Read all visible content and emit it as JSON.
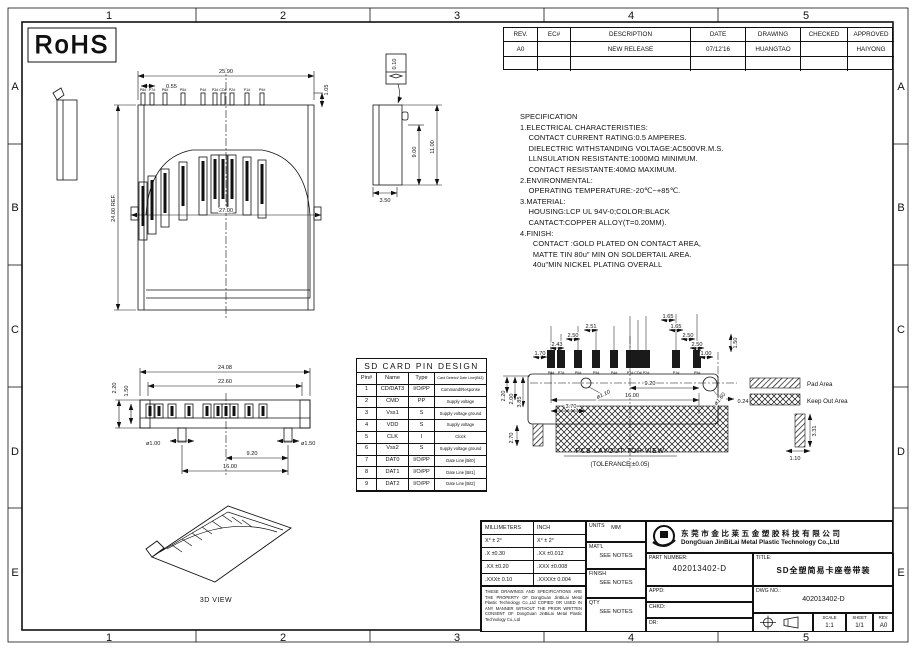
{
  "sheet": {
    "rohs": "RoHS",
    "zone_cols": [
      "1",
      "2",
      "3",
      "4",
      "5"
    ],
    "zone_rows": [
      "A",
      "B",
      "C",
      "D",
      "E"
    ]
  },
  "revision_table": {
    "headers": [
      "REV.",
      "EC#",
      "DESCRIPTION",
      "DATE",
      "DRAWING",
      "CHECKED",
      "APPROVED"
    ],
    "row": {
      "rev": "A0",
      "ec": "",
      "description": "NEW RELEASE",
      "date": "07/12'16",
      "drawing": "HUANGTAO",
      "checked": "",
      "approved": "HAIYONG"
    }
  },
  "specification": [
    "SPECIFICATION",
    "1.ELECTRICAL CHARACTERISTIES:",
    "    CONTACT CURRENT RATING:0.5 AMPERES.",
    "    DIELECTRIC WITHSTANDING VOLTAGE:AC500VR.M.S.",
    "    LLNSULATION RESISTANTE:1000MΩ MINIMUM.",
    "    CONTACT RESISTANTE:40MΩ MAXIMUM.",
    "2.ENVIRONMENTAL:",
    "    OPERATING TEMPERATURE:-20℃~+85℃.",
    "3.MATERIAL:",
    "    HOUSING:LCP UL 94V-0;COLOR:BLACK",
    "    CANTACT:COPPER ALLOY(T=0.20MM).",
    "4.FINISH:",
    "      CONTACT :GOLD PLATED ON CONTACT AREA,",
    "      MATTE TIN 80u\" MIN ON SOLDERTAIL AREA.",
    "      40u\"MIN NICKEL PLATING OVERALL"
  ],
  "pin_table": {
    "title": "SD CARD PIN DESIGN",
    "headers": [
      "Pin#",
      "Name",
      "Type",
      "Card Detetct/ Date Line(Bit3)"
    ],
    "rows": [
      [
        "1",
        "CD/DAT3",
        "I/O/PP",
        "Command/Response"
      ],
      [
        "2",
        "CMD",
        "PP",
        "Supply voltage"
      ],
      [
        "3",
        "Vss1",
        "S",
        "Supply voltage ground"
      ],
      [
        "4",
        "VDD",
        "S",
        "Supply voltage"
      ],
      [
        "5",
        "CLK",
        "I",
        "Clock"
      ],
      [
        "6",
        "Vss2",
        "S",
        "Supply voltage ground"
      ],
      [
        "7",
        "DAT0",
        "I/O/PP",
        "Date Line [Bit0]"
      ],
      [
        "8",
        "DAT1",
        "I/O/PP",
        "Date Line [Bit1]"
      ],
      [
        "9",
        "DAT2",
        "I/O/PP",
        "Date Line [Bit2]"
      ]
    ]
  },
  "pins": [
    "P8#",
    "P7#",
    "P6#",
    "P5#",
    "P4#",
    "P3#",
    "CD#",
    "P2#",
    "P1#",
    "P9#"
  ],
  "front_view": {
    "dim_width": "25.90",
    "dim_pitch": "0.55",
    "dim_lead": "1.05",
    "dim_flange": "27.00",
    "dim_depth": "24.00 REF."
  },
  "side_view": {
    "dim_inner": "9.00",
    "dim_outer": "11.00",
    "dim_width": "3.50",
    "flatness": "0.10"
  },
  "bottom_view": {
    "dim_overall": "24.08",
    "dim_body": "22.60",
    "dim_h1": "2.20",
    "dim_h2": "1.50",
    "dim_peg_left": "ø1.00",
    "dim_peg_right": "ø1.50",
    "dim_span1": "9.20",
    "dim_span2": "16.00"
  },
  "pcb_view": {
    "title": "PCB LAYOUT TOP VIEW",
    "tolerance": "(TOLERANCE:±0.05)",
    "d170": "1.70",
    "d243": "2.43",
    "d250a": "2.50",
    "d251": "2.51",
    "d165a": "1.65",
    "d165b": "1.65",
    "d250b": "2.50",
    "d250c": "2.50",
    "d100": "1.00",
    "d150": "1.50",
    "d110": "ø1.10",
    "d920": "9.20",
    "d1600": "16.00",
    "d370": "3.70",
    "d160": "ø1.60",
    "d024": "0.24",
    "d220": "2.20",
    "d200": "2.00",
    "d385": "3.85",
    "d270": "2.70",
    "d331": "3.31",
    "d110b": "1.10"
  },
  "legend": {
    "pad": "Pad Area",
    "keepout": "Keep Out Area"
  },
  "view3d_label": "3D VIEW",
  "title_block": {
    "tolerances": {
      "headers": [
        "MILLIMETERS",
        "INCH"
      ],
      "rows": [
        [
          "X°  ± 2°",
          "X°  ± 2°"
        ],
        [
          ".X  ±0.30",
          ".XX  ±0.012"
        ],
        [
          ".XX  ±0.20",
          ".XXX ±0.008"
        ],
        [
          ".XXX± 0.10",
          ".XXXX± 0.004"
        ]
      ]
    },
    "units_label": "UNITS",
    "units": "MM",
    "matl_label": "MAT'L",
    "matl": "SEE NOTES",
    "finish_label": "FINISH",
    "finish": "SEE NOTES",
    "qty_label": "QTY",
    "qty": "SEE NOTES",
    "legal": "THESE DRAWINGS AND SPECIFICATIONS ARE THE PROPERTY OF DongGuan JinBiLai Metal Plastic Technology Co.,Ltd COPIED OR USED IN ANY MANNER WITHOUT THE PRIOR WRITTEN CONSENT OF DongGuan JinBiLai Metal Plastic Technology Co.,Ltd",
    "company_cn": "东莞市金比莱五金塑胶科技有限公司",
    "company_en": "DongGuan JinBiLai Metal Plastic Technology Co.,Ltd",
    "part_number_label": "PART NUMBER:",
    "part_number": "402013402-D",
    "title_label": "TITLE:",
    "title": "SD全塑简易卡座卷带装",
    "dwg_label": "DWG NO.:",
    "dwg_no": "402013402-D",
    "appd_label": "APPD:",
    "chkd_label": "CHKD:",
    "dr_label": "DR:",
    "scale_label": "SCALE",
    "scale": "1:1",
    "sheet_label": "SHEET",
    "sheet": "1/1",
    "rev_label": "REV.",
    "rev": "A0"
  }
}
